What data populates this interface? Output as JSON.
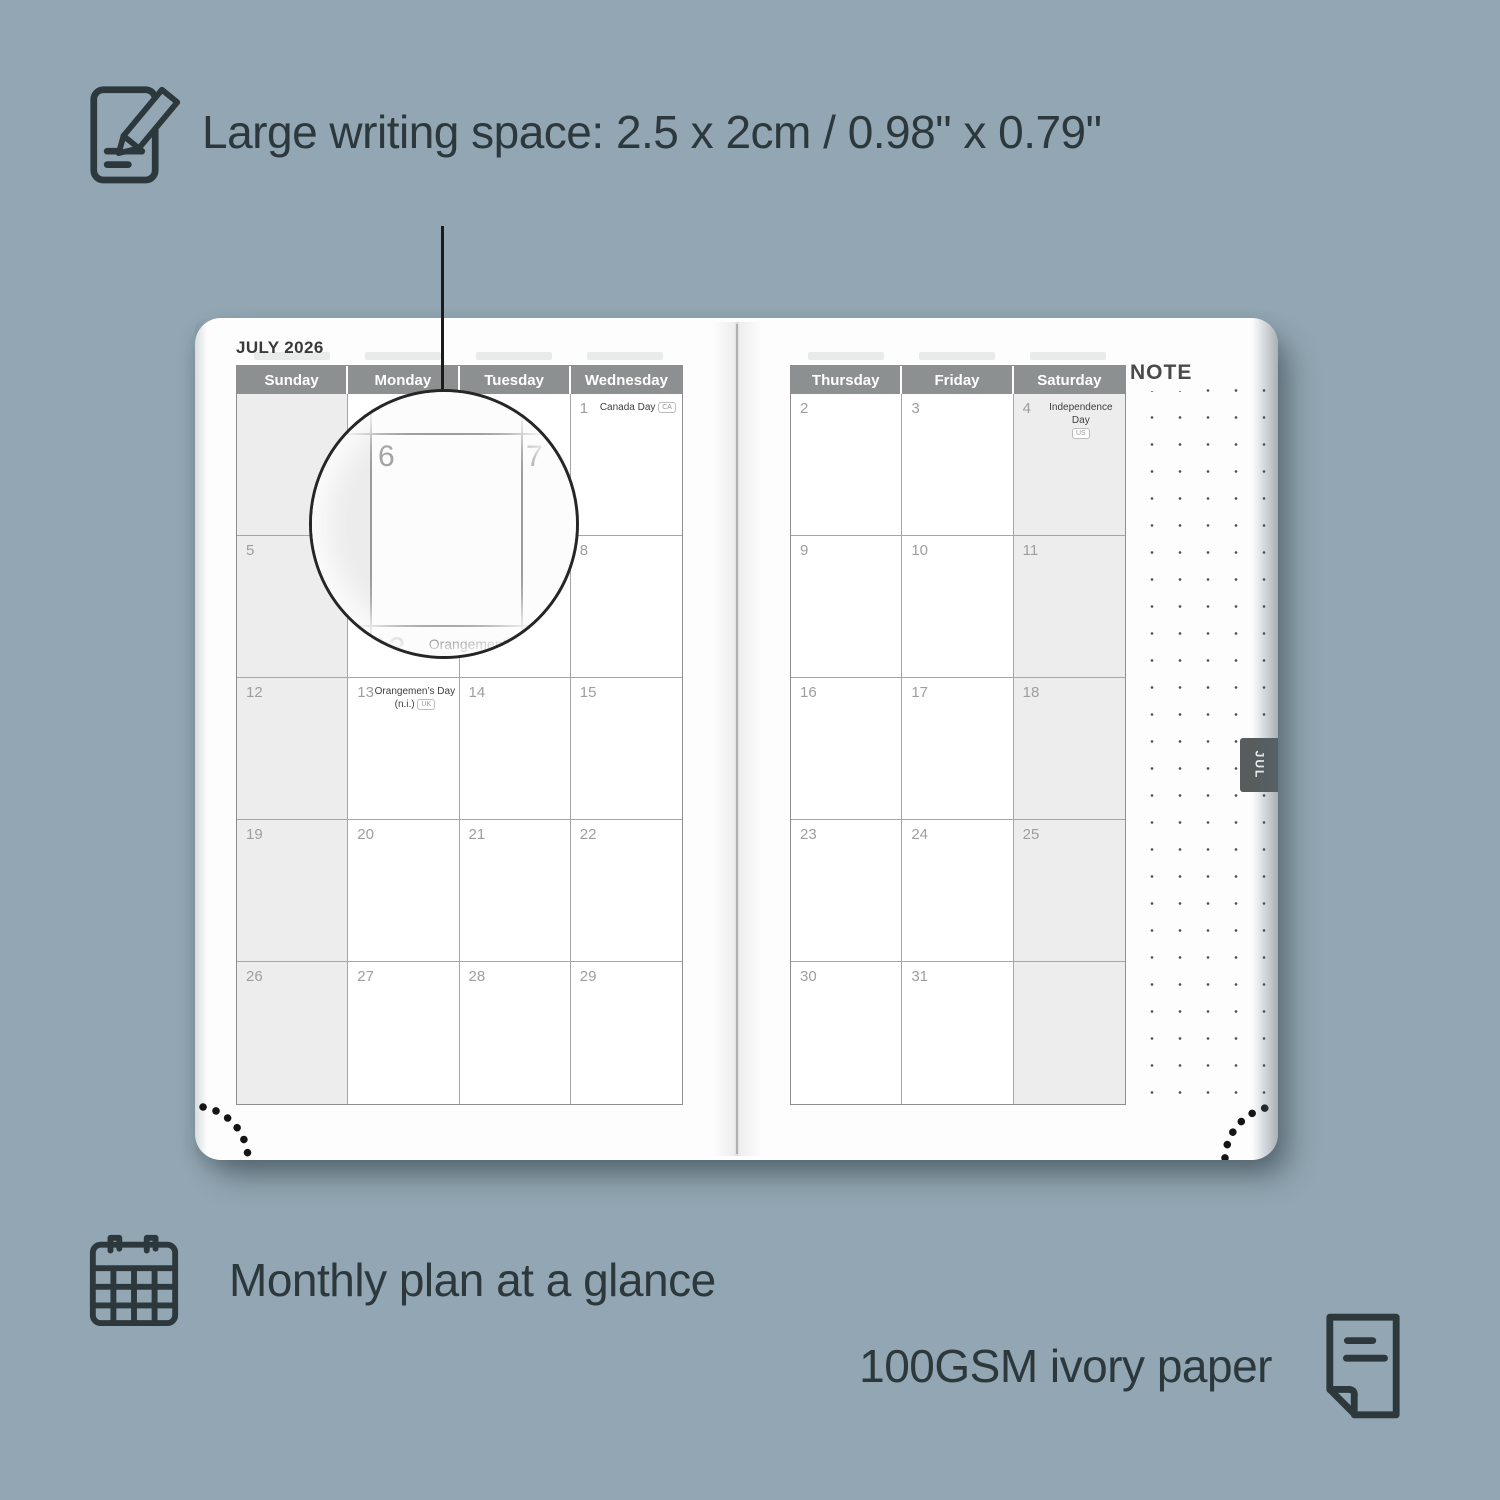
{
  "colors": {
    "background": "#92a7b3",
    "ink": "#2d383c",
    "page": "#fdfdfd",
    "header_bg": "#8d9090",
    "weekend_bg": "#ededed",
    "grid_line": "#a6a6a6",
    "day_number": "#9e9e9e",
    "tab_bg": "#575c5c"
  },
  "features": {
    "writing_space": "Large writing space: 2.5 x 2cm / 0.98\" x 0.79\"",
    "monthly_plan": "Monthly plan at a glance",
    "paper": "100GSM ivory paper"
  },
  "planner": {
    "month_title": "JULY 2026",
    "note_label": "NOTE",
    "tab_label": "JUL",
    "left_page": {
      "headers": [
        "Sunday",
        "Monday",
        "Tuesday",
        "Wednesday"
      ],
      "weekend_column": 0,
      "weeks": [
        [
          "",
          "",
          "",
          {
            "d": "1",
            "holiday": "Canada Day",
            "badge": "CA",
            "badge_pos": "inline"
          }
        ],
        [
          "5",
          "6",
          "7",
          "8"
        ],
        [
          "12",
          {
            "d": "13",
            "holiday": "Orangemen’s Day",
            "holiday2": "(n.i.)",
            "badge": "UK"
          },
          "14",
          "15"
        ],
        [
          "19",
          "20",
          "21",
          "22"
        ],
        [
          "26",
          "27",
          "28",
          "29"
        ]
      ]
    },
    "right_page": {
      "headers": [
        "Thursday",
        "Friday",
        "Saturday"
      ],
      "weekend_column": 2,
      "weeks": [
        [
          "2",
          "3",
          {
            "d": "4",
            "holiday": "Independence Day",
            "badge": "US",
            "badge_pos": "below"
          }
        ],
        [
          "9",
          "10",
          "11"
        ],
        [
          "16",
          "17",
          "18"
        ],
        [
          "23",
          "24",
          "25"
        ],
        [
          "30",
          "31",
          ""
        ]
      ]
    },
    "magnifier": {
      "left_day": "6",
      "right_day": "7",
      "bottom_day": "13",
      "holiday_line1": "Orangemen’s Day",
      "holiday_line2": "(n.i.)",
      "holiday_badge": "UK"
    }
  }
}
